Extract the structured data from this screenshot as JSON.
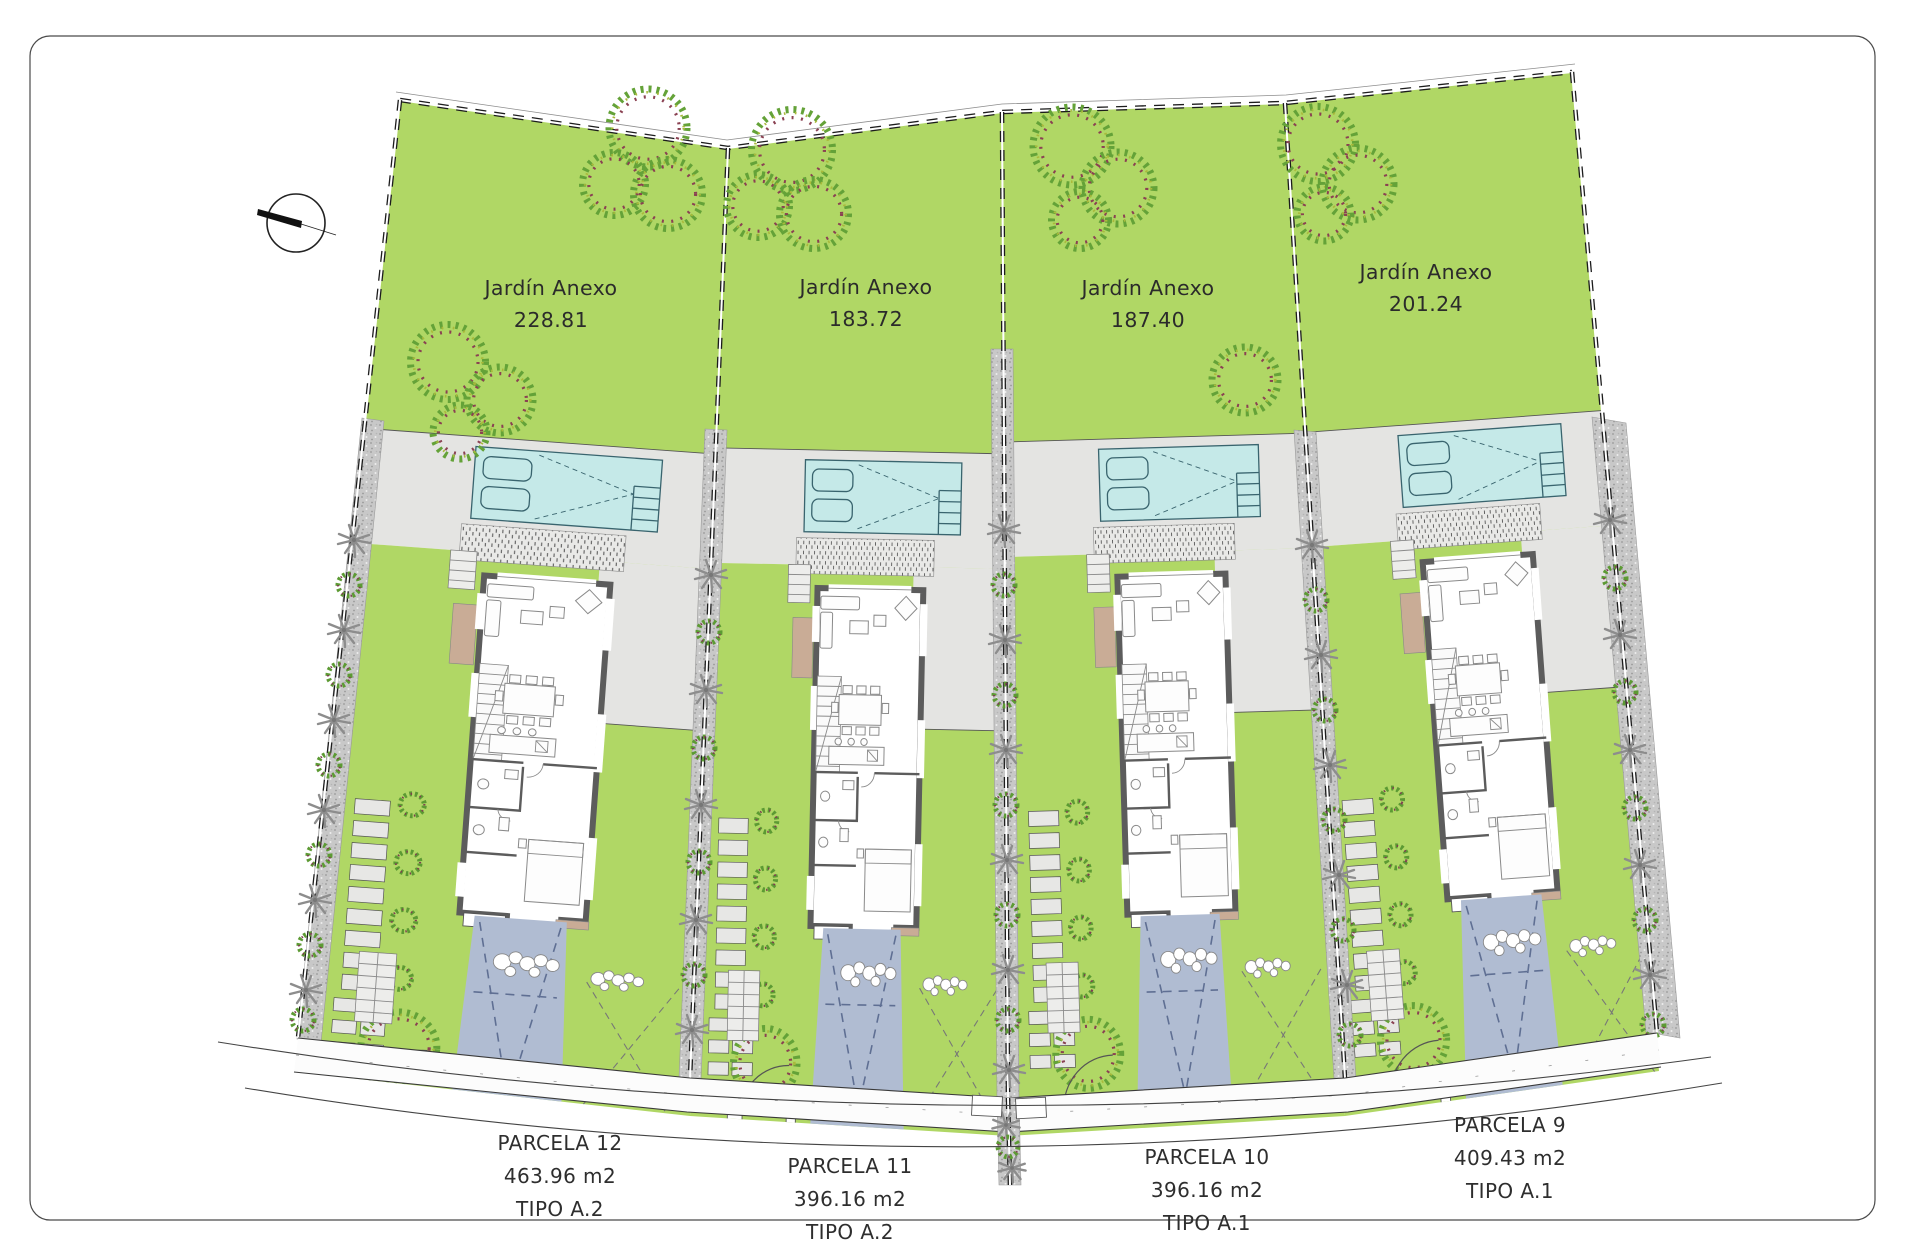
{
  "compass": {
    "icon": "north-arrow"
  },
  "gardens": [
    {
      "parcel": "12",
      "label": "Jardín Anexo",
      "area": "228.81"
    },
    {
      "parcel": "11",
      "label": "Jardín Anexo",
      "area": "183.72"
    },
    {
      "parcel": "10",
      "label": "Jardín Anexo",
      "area": "187.40"
    },
    {
      "parcel": "9",
      "label": "Jardín Anexo",
      "area": "201.24"
    }
  ],
  "parcels": [
    {
      "name": "PARCELA 12",
      "area": "463.96 m2",
      "tipo": "TIPO A.2"
    },
    {
      "name": "PARCELA 11",
      "area": "396.16 m2",
      "tipo": "TIPO A.2"
    },
    {
      "name": "PARCELA 10",
      "area": "396.16 m2",
      "tipo": "TIPO A.1"
    },
    {
      "name": "PARCELA 9",
      "area": "409.43 m2",
      "tipo": "TIPO A.1"
    }
  ],
  "colors": {
    "lawn": "#b0d765",
    "pool": "#c5e9e8",
    "terrace": "#e4e4e2",
    "driveway": "#b0bcd2",
    "wall": "#5c5c5c",
    "gravel": "#c8c8c8",
    "wood": "#c9ac96",
    "palm": "#8d8d8d",
    "bush": "#5c9a33",
    "bush_accent": "#7e3e50",
    "road_line": "#444444",
    "text": "#333333"
  }
}
